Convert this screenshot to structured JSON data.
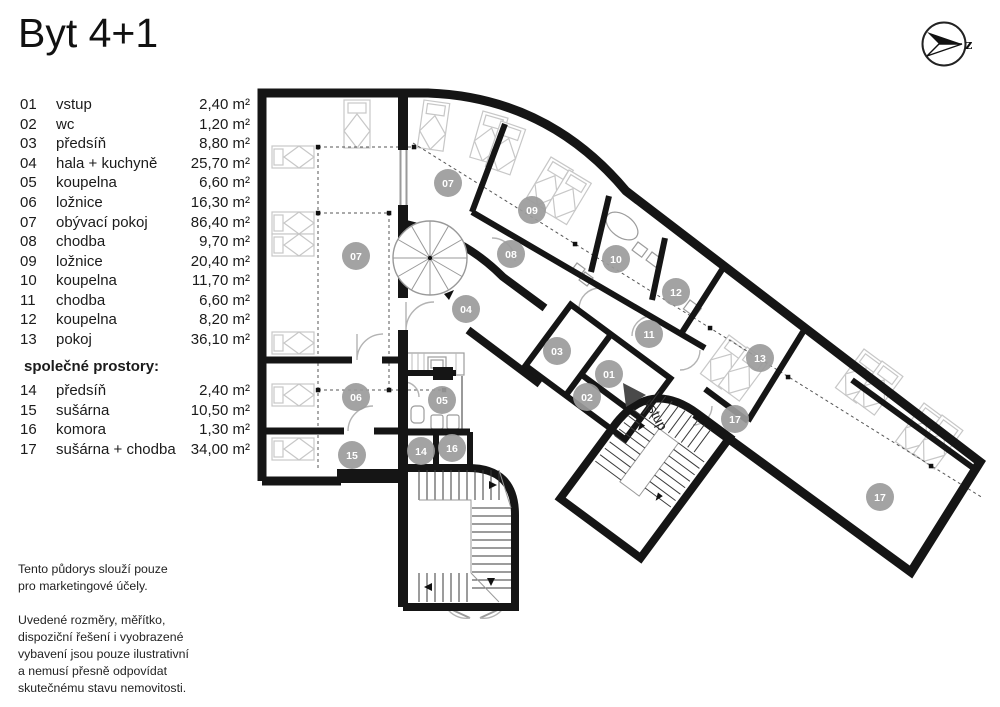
{
  "title": "Byt 4+1",
  "compass": {
    "letter": "z"
  },
  "legend": {
    "rooms": [
      {
        "num": "01",
        "name": "vstup",
        "area": "2,40 m²"
      },
      {
        "num": "02",
        "name": "wc",
        "area": "1,20 m²"
      },
      {
        "num": "03",
        "name": "předsíň",
        "area": "8,80 m²"
      },
      {
        "num": "04",
        "name": "hala + kuchyně",
        "area": "25,70 m²"
      },
      {
        "num": "05",
        "name": "koupelna",
        "area": "6,60 m²"
      },
      {
        "num": "06",
        "name": "ložnice",
        "area": "16,30 m²"
      },
      {
        "num": "07",
        "name": "obývací pokoj",
        "area": "86,40 m²"
      },
      {
        "num": "08",
        "name": "chodba",
        "area": "9,70 m²"
      },
      {
        "num": "09",
        "name": "ložnice",
        "area": "20,40 m²"
      },
      {
        "num": "10",
        "name": "koupelna",
        "area": "11,70 m²"
      },
      {
        "num": "11",
        "name": "chodba",
        "area": "6,60 m²"
      },
      {
        "num": "12",
        "name": "koupelna",
        "area": "8,20 m²"
      },
      {
        "num": "13",
        "name": "pokoj",
        "area": "36,10 m²"
      }
    ],
    "shared_heading": "společné prostory:",
    "shared_rooms": [
      {
        "num": "14",
        "name": "předsíň",
        "area": "2,40 m²"
      },
      {
        "num": "15",
        "name": "sušárna",
        "area": "10,50 m²"
      },
      {
        "num": "16",
        "name": "komora",
        "area": "1,30 m²"
      },
      {
        "num": "17",
        "name": "sušárna + chodba",
        "area": "34,00 m²"
      }
    ]
  },
  "plan": {
    "entrance_label": "vstup",
    "marker_color": "#9b9b9b",
    "marker_text_color": "#ffffff",
    "room_markers": [
      {
        "num": "07",
        "x": 448,
        "y": 183
      },
      {
        "num": "09",
        "x": 532,
        "y": 210
      },
      {
        "num": "08",
        "x": 511,
        "y": 254
      },
      {
        "num": "07",
        "x": 356,
        "y": 256
      },
      {
        "num": "10",
        "x": 616,
        "y": 259
      },
      {
        "num": "12",
        "x": 676,
        "y": 292
      },
      {
        "num": "04",
        "x": 466,
        "y": 309
      },
      {
        "num": "11",
        "x": 649,
        "y": 334
      },
      {
        "num": "03",
        "x": 557,
        "y": 351
      },
      {
        "num": "13",
        "x": 760,
        "y": 358
      },
      {
        "num": "01",
        "x": 609,
        "y": 374
      },
      {
        "num": "02",
        "x": 587,
        "y": 397
      },
      {
        "num": "06",
        "x": 356,
        "y": 397
      },
      {
        "num": "05",
        "x": 442,
        "y": 400
      },
      {
        "num": "17",
        "x": 735,
        "y": 419
      },
      {
        "num": "16",
        "x": 452,
        "y": 448
      },
      {
        "num": "14",
        "x": 421,
        "y": 451
      },
      {
        "num": "15",
        "x": 352,
        "y": 455
      },
      {
        "num": "17",
        "x": 880,
        "y": 497
      }
    ]
  },
  "footnotes": [
    "Tento půdorys slouží pouze\npro marketingové účely.",
    "Uvedené rozměry, měřítko,\ndispoziční řešení i vyobrazené\nvybavení jsou pouze ilustrativní\na nemusí přesně odpovídat\nskutečnému stavu nemovitosti."
  ]
}
